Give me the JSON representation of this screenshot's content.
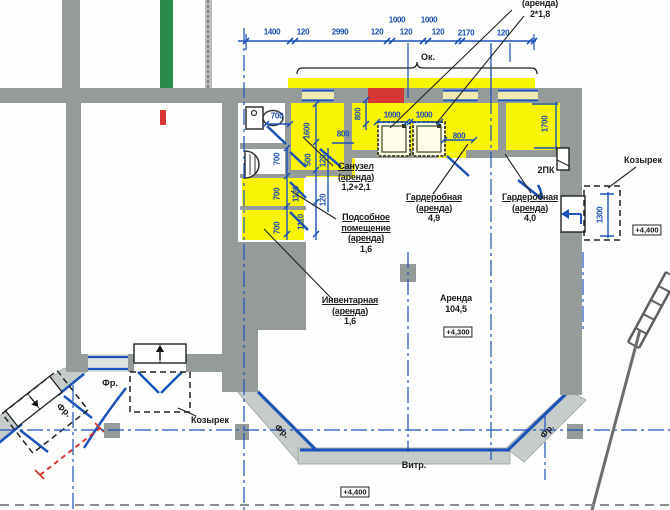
{
  "colors": {
    "wall": "#949b98",
    "wall_light": "#c6ccc9",
    "blue": "#1d52b8",
    "yellow": "#f8f406",
    "red": "#d53832",
    "green": "#2b8a4d"
  },
  "dims": {
    "top_chain": [
      "1400",
      "120",
      "2990",
      "120",
      "1000",
      "120",
      "1000",
      "120",
      "2170",
      "120"
    ],
    "h": {
      "d700_door": "700",
      "d800_san": "800",
      "d1000_1": "1000",
      "d1000_2": "1000",
      "d800_gard": "800"
    },
    "v": {
      "d1600": "1600",
      "d800": "800",
      "d700_1": "700",
      "d700_2": "700",
      "d700_3": "700",
      "d500": "500",
      "d120_1": "120",
      "d1120": "1120",
      "d120_2": "120",
      "d1110": "1110",
      "d1700": "1700",
      "d1300": "1300"
    }
  },
  "labels": {
    "ok": "Ок.",
    "top_right": {
      "line1": "(аренда)",
      "line2": "2*1,8"
    },
    "sanuzel": {
      "l1": "Санузел",
      "l2": "(аренда)",
      "l3": "1,2+2,1"
    },
    "podsobnoe": {
      "l1": "Подсобное",
      "l2": "помещение",
      "l3": "(аренда)",
      "l4": "1,6"
    },
    "inventarnaya": {
      "l1": "Инвентарная",
      "l2": "(аренда)",
      "l3": "1,6"
    },
    "garderobnaya_1": {
      "l1": "Гардеробная",
      "l2": "(аренда)",
      "l3": "4,9"
    },
    "garderobnaya_2": {
      "l1": "Гардеробная",
      "l2": "(аренда)",
      "l3": "4,0"
    },
    "arenda": {
      "l1": "Аренда",
      "l2": "104,5"
    },
    "kozyrek_right": "Козырек",
    "kozyrek_left": "Козырек",
    "fr_1": "Фр.",
    "fr_2": "Фр.",
    "fr_3": "Фр.",
    "fr_4": "Фр.",
    "vitr": "Витр.",
    "pk": "2ПК"
  },
  "elevations": {
    "main": "+4,300",
    "bottom": "+4,400",
    "right": "+4,400"
  }
}
